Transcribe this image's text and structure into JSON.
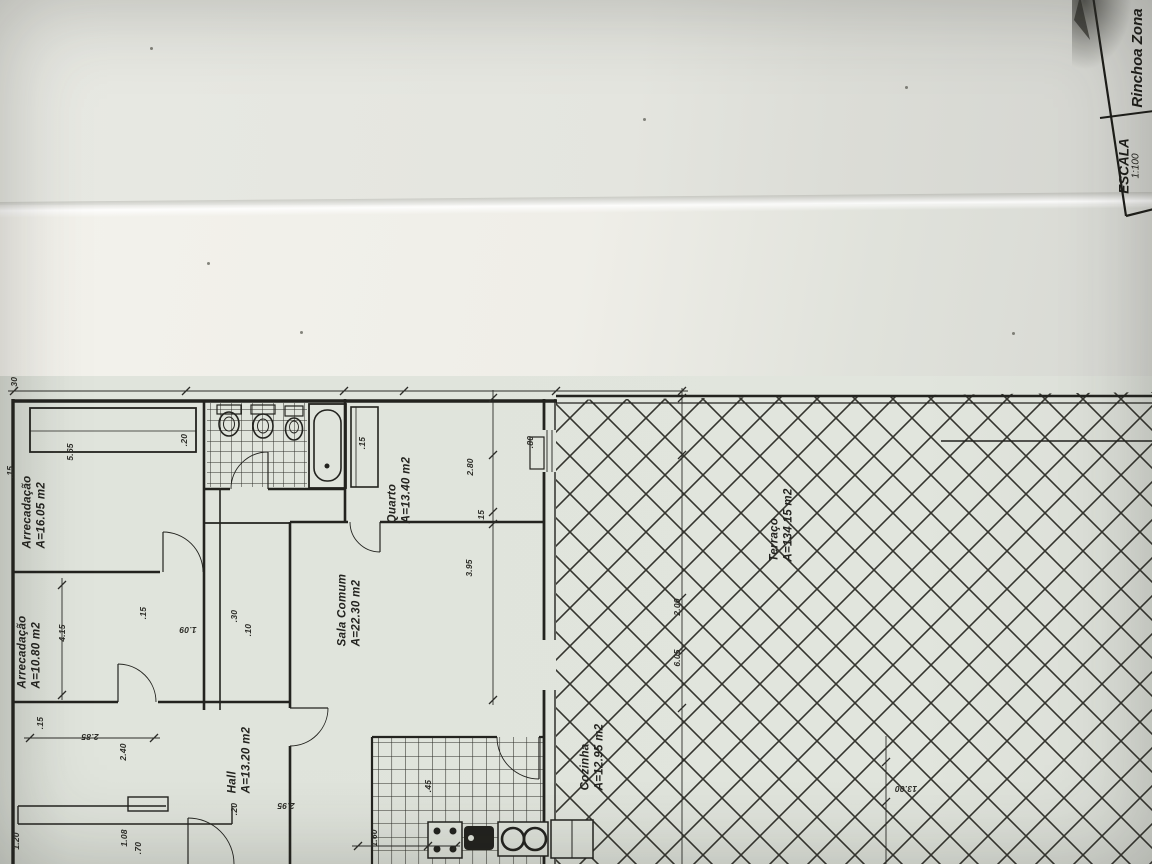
{
  "document": {
    "kind": "floor-plan-photo",
    "title_block": {
      "escala_label": "ESCALA",
      "escala_value": "1:100",
      "zone_label": "Rinchoa Zona"
    },
    "rooms": [
      {
        "name": "Arrecadação",
        "area": "A=16.05 m2"
      },
      {
        "name": "Arrecadação",
        "area": "A=10.80 m2"
      },
      {
        "name": "Hall",
        "area": "A=13.20 m2"
      },
      {
        "name": "Sala Comum",
        "area": "A=22.30 m2"
      },
      {
        "name": "Quarto",
        "area": "A=13.40 m2"
      },
      {
        "name": "Cozinha",
        "area": "A=12.95 m2"
      },
      {
        "name": "Terraço",
        "area": "A=134.15 m2"
      }
    ],
    "dimensions": [
      {
        "value": ".30",
        "x": 14,
        "y": 383,
        "rot": -90
      },
      {
        "value": ".20",
        "x": 184,
        "y": 440,
        "rot": -90
      },
      {
        "value": "5.65",
        "x": 70,
        "y": 452,
        "rot": -90
      },
      {
        "value": ".15",
        "x": 10,
        "y": 472,
        "rot": -90
      },
      {
        "value": ".15",
        "x": 362,
        "y": 443,
        "rot": -90
      },
      {
        "value": ".80",
        "x": 530,
        "y": 442,
        "rot": -90
      },
      {
        "value": "2.80",
        "x": 470,
        "y": 467,
        "rot": -90
      },
      {
        "value": ".15",
        "x": 481,
        "y": 516,
        "rot": -90
      },
      {
        "value": "3.95",
        "x": 469,
        "y": 568,
        "rot": -90
      },
      {
        "value": ".15",
        "x": 143,
        "y": 613,
        "rot": -90
      },
      {
        "value": "1.09",
        "x": 188,
        "y": 630,
        "rot": 180
      },
      {
        "value": ".30",
        "x": 234,
        "y": 616,
        "rot": -90
      },
      {
        "value": ".10",
        "x": 248,
        "y": 630,
        "rot": -90
      },
      {
        "value": "4.15",
        "x": 62,
        "y": 633,
        "rot": -90
      },
      {
        "value": ".15",
        "x": 40,
        "y": 723,
        "rot": -90
      },
      {
        "value": "2.85",
        "x": 90,
        "y": 737,
        "rot": 180
      },
      {
        "value": "2.40",
        "x": 123,
        "y": 752,
        "rot": -90
      },
      {
        "value": "1.20",
        "x": 16,
        "y": 841,
        "rot": -90
      },
      {
        "value": "1.08",
        "x": 124,
        "y": 838,
        "rot": -90
      },
      {
        "value": ".70",
        "x": 138,
        "y": 848,
        "rot": -90
      },
      {
        "value": ".20",
        "x": 234,
        "y": 809,
        "rot": -90
      },
      {
        "value": "2.95",
        "x": 286,
        "y": 806,
        "rot": 180
      },
      {
        "value": "1.60",
        "x": 374,
        "y": 838,
        "rot": -90
      },
      {
        "value": ".45",
        "x": 428,
        "y": 786,
        "rot": -90
      },
      {
        "value": "2.00",
        "x": 677,
        "y": 607,
        "rot": -90
      },
      {
        "value": "6.05",
        "x": 677,
        "y": 658,
        "rot": -90
      },
      {
        "value": "13.00",
        "x": 906,
        "y": 789,
        "rot": 180
      }
    ],
    "colors": {
      "paper": "#dfe3db",
      "paper_bright": "#f3f2ec",
      "paper_shadow": "#d6d7d2",
      "ink": "#23231f"
    }
  }
}
